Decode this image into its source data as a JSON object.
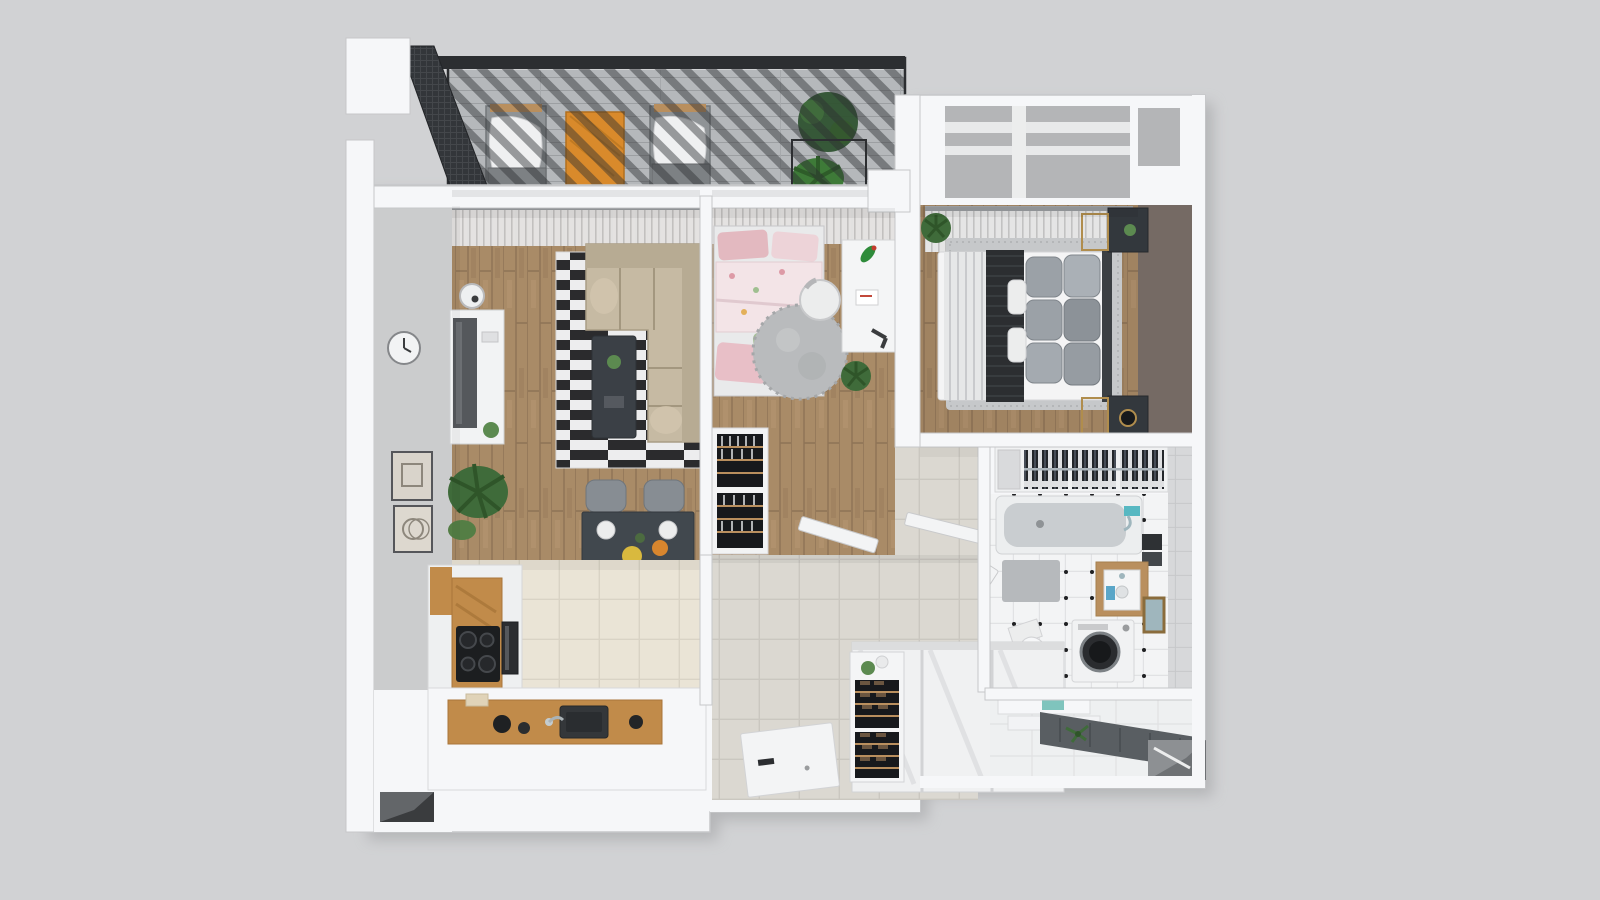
{
  "scene": {
    "kind": "3d-apartment-floor-plan-render",
    "rooms": [
      {
        "id": "terrace",
        "label": "Terrace",
        "furniture": [
          "pergola-slat-roof",
          "privacy-mesh-screen",
          "lounge-chair",
          "wooden-coffee-table",
          "lounge-chair",
          "planter-box",
          "potted-plants",
          "gray-deck"
        ]
      },
      {
        "id": "living-room",
        "label": "Living room",
        "furniture": [
          "corner-sofa",
          "striped-rug",
          "coffee-table",
          "tv-console",
          "tv",
          "wall-clock",
          "picture-frame",
          "picture-frame",
          "palm-plant",
          "dining-table",
          "dining-chair",
          "dining-chair",
          "dining-chair",
          "dining-chair",
          "window-blinds"
        ]
      },
      {
        "id": "kitchen",
        "label": "Kitchen",
        "furniture": [
          "tall-cabinet",
          "cooktop",
          "built-in-oven",
          "island-counter",
          "sink",
          "kettle",
          "vent-window"
        ]
      },
      {
        "id": "kids-room",
        "label": "Kids room",
        "furniture": [
          "single-bed",
          "floral-duvet",
          "round-rug",
          "desk",
          "desk-chair",
          "toy-parrot",
          "bookshelf",
          "potted-plant",
          "window-blinds",
          "door"
        ]
      },
      {
        "id": "bedroom",
        "label": "Bedroom",
        "furniture": [
          "double-bed",
          "knit-throw",
          "pillows",
          "area-rug",
          "nightstand",
          "nightstand",
          "gold-frame",
          "curtains",
          "accent-wall",
          "potted-plant",
          "open-wardrobe-clothes",
          "roof-window-well"
        ]
      },
      {
        "id": "bathroom",
        "label": "Bathroom",
        "furniture": [
          "bathtub",
          "faucet",
          "vanity-washbasin",
          "washing-machine",
          "toilet",
          "bath-mat",
          "towels",
          "mirror",
          "door"
        ]
      },
      {
        "id": "hallway",
        "label": "Hallway",
        "furniture": [
          "sliding-wardrobe",
          "shoe-rack",
          "storage-box",
          "open-door-leaf",
          "door",
          "door"
        ]
      },
      {
        "id": "entrance",
        "label": "Entrance",
        "furniture": [
          "doormat-runner",
          "shoe-bench",
          "front-door-recess",
          "plant-sprig"
        ]
      }
    ]
  },
  "colors": {
    "background": "#d1d2d4",
    "wall": "#f6f7f9",
    "wallEdge": "#c6c7c9",
    "grayWall": "#cbcccd",
    "accentWall": "#756a64",
    "wood": "#a98b67",
    "woodDark": "#8f7456",
    "deck": "#b5b8bb",
    "deckLine": "#9c9fa2",
    "pergola": "#2c2e31",
    "mesh": "#33363a",
    "blinds": "#e9eaec",
    "blindsLine": "#c4c5c7",
    "kitchenTile": "#eae4d6",
    "kitchenTileLine": "#d9d3c5",
    "hallTile": "#dbd8d1",
    "hallTileLine": "#cac7c0",
    "bathTile": "#f3f4f5",
    "bathDot": "#1f2022",
    "bathWallTile": "#d7d8da",
    "sofa": "#c6baa3",
    "sofaShade": "#b0a48c",
    "rugBlack": "#2b2b2d",
    "rugWhite": "#ededee",
    "coffeeTable": "#3b4046",
    "diningTable": "#41484e",
    "chair": "#878d93",
    "plant": "#3f6b3a",
    "plantLight": "#5c8a50",
    "pinkPillow": "#e3b9c0",
    "pinkSoft": "#edd3d8",
    "floral": "#f3e4e7",
    "greenPillow": "#a9bf9b",
    "roundRug": "#b9bbbd",
    "desk": "#f4f5f6",
    "console": "#f2f3f4",
    "tv": "#55585c",
    "orangeTable": "#d98a2b",
    "bedWhite": "#f4f4f5",
    "throw": "#2c2e31",
    "pillowGray": "#9ba1a7",
    "bedRug": "#c6c8ca",
    "nightstand": "#33383d",
    "gold": "#b08d4d",
    "clothesDark": "#23262a",
    "tub": "#eceeef",
    "tubInner": "#c9cdd0",
    "washer": "#f1f2f3",
    "washerDoor": "#2a2c2f",
    "doormat": "#595e62",
    "wardrobe": "#f0f1f2",
    "shoeDark": "#3c2f23",
    "shelfWood": "#b98f5e",
    "vanityWood": "#b98f5e",
    "teal": "#57b8c2",
    "doorLeaf": "#f3f4f5",
    "cabinetWood": "#c18b4a",
    "cooktop": "#1c1e20",
    "shelfInner": "#17191c"
  }
}
